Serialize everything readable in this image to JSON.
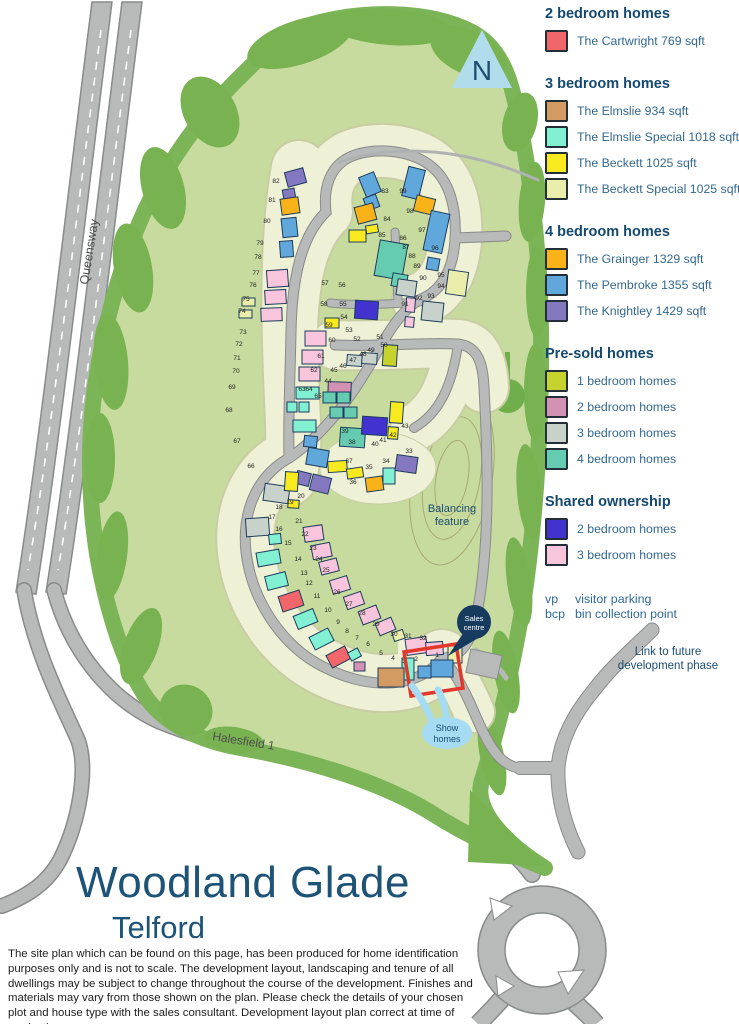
{
  "title": {
    "name": "Woodland Glade",
    "town": "Telford"
  },
  "disclaimer": "The site plan which can be found on this page, has been produced for home identification purposes only and is not to scale. The development layout, landscaping and tenure of all dwellings may be subject to change throughout the course of the development. Finishes and materials may vary from those shown on the plan. Please check the details of your chosen plot and house type with the sales consultant. Development layout plan correct at time of production.",
  "colors": {
    "cartwright": "#f0666b",
    "elmslie": "#d39a62",
    "elmslie_special": "#82f1d3",
    "beckett": "#f8ea1f",
    "beckett_special": "#ebeeab",
    "grainger": "#f9b318",
    "pembroke": "#60a8dc",
    "knightley": "#8478c1",
    "presold1": "#c6d32f",
    "presold2": "#d392b3",
    "presold3": "#c8d2ca",
    "presold4": "#65cbb1",
    "shared2": "#4232cf",
    "shared3": "#f8c5dc"
  },
  "legend": {
    "sections": [
      {
        "heading": "2 bedroom homes",
        "items": [
          {
            "label": "The Cartwright 769 sqft",
            "color_key": "cartwright"
          }
        ]
      },
      {
        "heading": "3 bedroom homes",
        "items": [
          {
            "label": "The Elmslie 934 sqft",
            "color_key": "elmslie"
          },
          {
            "label": "The Elmslie Special 1018 sqft",
            "color_key": "elmslie_special"
          },
          {
            "label": "The Beckett 1025 sqft",
            "color_key": "beckett"
          },
          {
            "label": "The Beckett Special 1025 sqft",
            "color_key": "beckett_special"
          }
        ]
      },
      {
        "heading": "4 bedroom homes",
        "items": [
          {
            "label": "The Grainger 1329 sqft",
            "color_key": "grainger"
          },
          {
            "label": "The Pembroke 1355 sqft",
            "color_key": "pembroke"
          },
          {
            "label": "The Knightley 1429 sqft",
            "color_key": "knightley"
          }
        ]
      },
      {
        "heading": "Pre-sold homes",
        "items": [
          {
            "label": "1 bedroom homes",
            "color_key": "presold1"
          },
          {
            "label": "2 bedroom homes",
            "color_key": "presold2"
          },
          {
            "label": "3 bedroom homes",
            "color_key": "presold3"
          },
          {
            "label": "4 bedroom homes",
            "color_key": "presold4"
          }
        ]
      },
      {
        "heading": "Shared ownership",
        "items": [
          {
            "label": "2 bedroom homes",
            "color_key": "shared2"
          },
          {
            "label": "3 bedroom homes",
            "color_key": "shared3"
          }
        ]
      }
    ],
    "notes": [
      {
        "abbr": "vp",
        "label": "visitor parking"
      },
      {
        "abbr": "bcp",
        "label": "bin collection point"
      }
    ],
    "future_link_line1": "Link to future",
    "future_link_line2": "development phase"
  },
  "map": {
    "labels": {
      "north": "N",
      "queensway": "Queensway",
      "halesfield": "Halesfield 1",
      "balancing_1": "Balancing",
      "balancing_2": "feature",
      "sales_1": "Sales",
      "sales_2": "centre",
      "show_1": "Show",
      "show_2": "homes"
    },
    "plots": [
      [
        1,
        437,
        657
      ],
      [
        2,
        416,
        661
      ],
      [
        3,
        404,
        663
      ],
      [
        4,
        393,
        660
      ],
      [
        5,
        381,
        655
      ],
      [
        6,
        368,
        646
      ],
      [
        7,
        357,
        640
      ],
      [
        8,
        347,
        633
      ],
      [
        9,
        338,
        624
      ],
      [
        10,
        328,
        612
      ],
      [
        11,
        317,
        598
      ],
      [
        12,
        309,
        585
      ],
      [
        13,
        304,
        575
      ],
      [
        14,
        298,
        561
      ],
      [
        15,
        288,
        545
      ],
      [
        16,
        279,
        531
      ],
      [
        17,
        272,
        519
      ],
      [
        18,
        279,
        509
      ],
      [
        19,
        290,
        504
      ],
      [
        20,
        301,
        498
      ],
      [
        21,
        299,
        523
      ],
      [
        22,
        305,
        536
      ],
      [
        23,
        313,
        550
      ],
      [
        24,
        319,
        561
      ],
      [
        25,
        326,
        572
      ],
      [
        26,
        337,
        594
      ],
      [
        27,
        349,
        606
      ],
      [
        28,
        362,
        615
      ],
      [
        29,
        376,
        626
      ],
      [
        30,
        394,
        636
      ],
      [
        31,
        408,
        638
      ],
      [
        32,
        423,
        640
      ],
      [
        33,
        409,
        453
      ],
      [
        34,
        386,
        463
      ],
      [
        35,
        369,
        469
      ],
      [
        36,
        353,
        484
      ],
      [
        37,
        349,
        463
      ],
      [
        38,
        352,
        444
      ],
      [
        39,
        345,
        433
      ],
      [
        40,
        375,
        446
      ],
      [
        41,
        383,
        442
      ],
      [
        42,
        393,
        437
      ],
      [
        43,
        405,
        428
      ],
      [
        44,
        328,
        383
      ],
      [
        45,
        334,
        372
      ],
      [
        46,
        343,
        368
      ],
      [
        47,
        353,
        362
      ],
      [
        48,
        363,
        356
      ],
      [
        49,
        371,
        352
      ],
      [
        50,
        384,
        347
      ],
      [
        51,
        380,
        339
      ],
      [
        52,
        357,
        341
      ],
      [
        53,
        349,
        332
      ],
      [
        54,
        344,
        319
      ],
      [
        55,
        343,
        306
      ],
      [
        56,
        342,
        287
      ],
      [
        57,
        325,
        285
      ],
      [
        58,
        324,
        306
      ],
      [
        59,
        329,
        327
      ],
      [
        60,
        332,
        342
      ],
      [
        61,
        321,
        358
      ],
      [
        62,
        314,
        372
      ],
      [
        63,
        302,
        391
      ],
      [
        64,
        309,
        391
      ],
      [
        65,
        318,
        398
      ],
      [
        66,
        251,
        468
      ],
      [
        67,
        237,
        443
      ],
      [
        68,
        229,
        412
      ],
      [
        69,
        232,
        389
      ],
      [
        70,
        236,
        373
      ],
      [
        71,
        237,
        360
      ],
      [
        72,
        239,
        346
      ],
      [
        73,
        243,
        334
      ],
      [
        74,
        242,
        313
      ],
      [
        75,
        246,
        301
      ],
      [
        76,
        253,
        287
      ],
      [
        77,
        256,
        275
      ],
      [
        78,
        258,
        259
      ],
      [
        79,
        260,
        245
      ],
      [
        80,
        267,
        223
      ],
      [
        81,
        272,
        202
      ],
      [
        82,
        276,
        183
      ],
      [
        83,
        385,
        193
      ],
      [
        84,
        387,
        221
      ],
      [
        85,
        382,
        237
      ],
      [
        86,
        403,
        240
      ],
      [
        87,
        406,
        249
      ],
      [
        88,
        412,
        258
      ],
      [
        89,
        417,
        268
      ],
      [
        90,
        423,
        280
      ],
      [
        91,
        405,
        306
      ],
      [
        92,
        419,
        300
      ],
      [
        93,
        431,
        298
      ],
      [
        94,
        441,
        288
      ],
      [
        95,
        441,
        277
      ],
      [
        96,
        435,
        250
      ],
      [
        97,
        422,
        232
      ],
      [
        98,
        410,
        213
      ],
      [
        99,
        403,
        193
      ]
    ],
    "houses": [
      [
        362,
        174,
        16,
        21,
        "pembroke",
        -22
      ],
      [
        365,
        196,
        13,
        13,
        "pembroke",
        -20
      ],
      [
        356,
        205,
        19,
        17,
        "grainger",
        -15
      ],
      [
        366,
        225,
        12,
        8,
        "beckett",
        -10
      ],
      [
        349,
        230,
        17,
        12,
        "beckett",
        0
      ],
      [
        405,
        168,
        17,
        30,
        "pembroke",
        14
      ],
      [
        415,
        197,
        19,
        16,
        "grainger",
        14
      ],
      [
        427,
        212,
        19,
        40,
        "pembroke",
        12
      ],
      [
        427,
        258,
        12,
        12,
        "pembroke",
        10
      ],
      [
        377,
        242,
        28,
        36,
        "presold4",
        10
      ],
      [
        392,
        274,
        15,
        13,
        "presold4",
        10
      ],
      [
        397,
        280,
        19,
        16,
        "presold3",
        8
      ],
      [
        447,
        271,
        20,
        24,
        "beckett_special",
        8
      ],
      [
        406,
        298,
        9,
        14,
        "shared3",
        5
      ],
      [
        422,
        302,
        21,
        19,
        "presold3",
        6
      ],
      [
        405,
        317,
        9,
        10,
        "shared3",
        5
      ],
      [
        286,
        170,
        19,
        15,
        "knightley",
        -15
      ],
      [
        283,
        189,
        12,
        10,
        "knightley",
        -10
      ],
      [
        281,
        198,
        18,
        16,
        "grainger",
        -8
      ],
      [
        282,
        218,
        15,
        19,
        "pembroke",
        -6
      ],
      [
        280,
        241,
        13,
        16,
        "pembroke",
        -4
      ],
      [
        267,
        270,
        21,
        17,
        "shared3",
        -4
      ],
      [
        265,
        290,
        21,
        14,
        "shared3",
        -3
      ],
      [
        261,
        308,
        21,
        13,
        "shared3",
        -2
      ],
      [
        242,
        298,
        13,
        8,
        "beckett_special",
        0
      ],
      [
        239,
        310,
        13,
        8,
        "beckett_special",
        0
      ],
      [
        305,
        331,
        21,
        15,
        "shared3",
        0
      ],
      [
        302,
        350,
        21,
        14,
        "shared3",
        0
      ],
      [
        299,
        367,
        21,
        14,
        "shared3",
        0
      ],
      [
        296,
        387,
        23,
        12,
        "elmslie_special",
        0
      ],
      [
        287,
        402,
        10,
        10,
        "elmslie_special",
        0
      ],
      [
        299,
        402,
        10,
        10,
        "elmslie_special",
        0
      ],
      [
        293,
        420,
        23,
        12,
        "elmslie_special",
        0
      ],
      [
        304,
        436,
        13,
        11,
        "pembroke",
        6
      ],
      [
        307,
        449,
        21,
        17,
        "pembroke",
        10
      ],
      [
        296,
        472,
        14,
        13,
        "knightley",
        14
      ],
      [
        311,
        476,
        19,
        16,
        "knightley",
        14
      ],
      [
        355,
        301,
        23,
        18,
        "shared2",
        4
      ],
      [
        325,
        318,
        14,
        10,
        "beckett",
        0
      ],
      [
        383,
        345,
        14,
        21,
        "presold1",
        4
      ],
      [
        347,
        355,
        15,
        11,
        "presold3",
        4
      ],
      [
        362,
        353,
        15,
        11,
        "presold3",
        4
      ],
      [
        328,
        382,
        23,
        18,
        "presold2",
        2
      ],
      [
        323,
        392,
        13,
        11,
        "presold4",
        0
      ],
      [
        337,
        392,
        13,
        11,
        "presold4",
        0
      ],
      [
        330,
        407,
        13,
        11,
        "presold4",
        0
      ],
      [
        344,
        407,
        13,
        11,
        "presold4",
        0
      ],
      [
        340,
        428,
        25,
        19,
        "presold4",
        4
      ],
      [
        362,
        417,
        25,
        18,
        "shared2",
        4
      ],
      [
        390,
        402,
        13,
        21,
        "beckett",
        4
      ],
      [
        388,
        427,
        10,
        12,
        "beckett",
        4
      ],
      [
        328,
        461,
        19,
        11,
        "beckett",
        -4
      ],
      [
        347,
        468,
        16,
        10,
        "beckett",
        -8
      ],
      [
        366,
        477,
        17,
        14,
        "grainger",
        -8
      ],
      [
        383,
        468,
        12,
        16,
        "elmslie_special",
        0
      ],
      [
        396,
        456,
        21,
        16,
        "knightley",
        8
      ],
      [
        264,
        485,
        25,
        17,
        "presold3",
        8
      ],
      [
        285,
        472,
        13,
        19,
        "beckett",
        4
      ],
      [
        288,
        500,
        11,
        8,
        "beckett",
        4
      ],
      [
        246,
        518,
        23,
        18,
        "presold3",
        -4
      ],
      [
        269,
        534,
        12,
        10,
        "elmslie_special",
        -6
      ],
      [
        257,
        551,
        23,
        14,
        "elmslie_special",
        -10
      ],
      [
        266,
        574,
        21,
        14,
        "elmslie_special",
        -14
      ],
      [
        280,
        593,
        22,
        16,
        "cartwright",
        -18
      ],
      [
        295,
        612,
        21,
        14,
        "elmslie_special",
        -22
      ],
      [
        311,
        632,
        21,
        14,
        "elmslie_special",
        -27
      ],
      [
        328,
        650,
        21,
        14,
        "cartwright",
        -28
      ],
      [
        349,
        650,
        11,
        9,
        "elmslie_special",
        -28
      ],
      [
        304,
        526,
        19,
        15,
        "shared3",
        -8
      ],
      [
        312,
        544,
        19,
        14,
        "shared3",
        -11
      ],
      [
        320,
        560,
        18,
        13,
        "shared3",
        -14
      ],
      [
        331,
        578,
        18,
        14,
        "shared3",
        -17
      ],
      [
        345,
        594,
        18,
        13,
        "shared3",
        -19
      ],
      [
        360,
        608,
        19,
        14,
        "shared3",
        -21
      ],
      [
        377,
        620,
        17,
        13,
        "shared3",
        -23
      ],
      [
        393,
        631,
        11,
        9,
        "beckett_special",
        -18
      ],
      [
        406,
        638,
        21,
        16,
        "shared3",
        -8
      ],
      [
        426,
        642,
        17,
        13,
        "shared3",
        -4
      ],
      [
        448,
        646,
        14,
        17,
        "beckett_special",
        0
      ],
      [
        402,
        658,
        12,
        22,
        "elmslie_special",
        0
      ],
      [
        418,
        666,
        13,
        12,
        "pembroke",
        0
      ],
      [
        431,
        660,
        22,
        17,
        "pembroke",
        0
      ],
      [
        378,
        668,
        26,
        19,
        "elmslie",
        0
      ],
      [
        354,
        662,
        11,
        9,
        "presold2",
        0
      ]
    ]
  }
}
